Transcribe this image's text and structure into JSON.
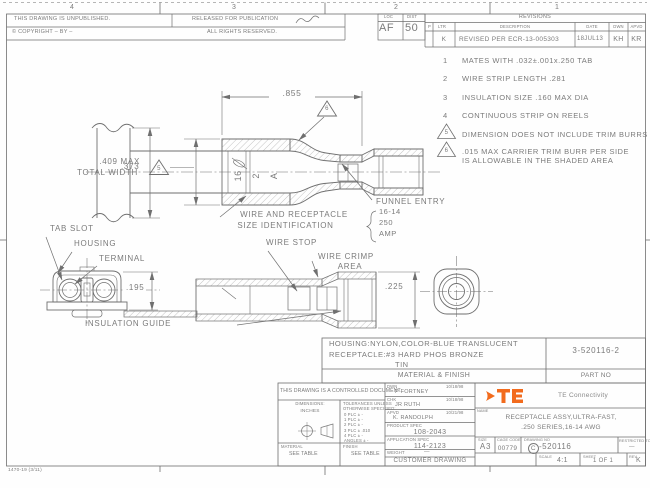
{
  "zones": {
    "z4": "4",
    "z3": "3",
    "z2": "2",
    "z1": "1"
  },
  "header": {
    "unpublished": "THIS DRAWING IS UNPUBLISHED.",
    "released": "RELEASED FOR PUBLICATION",
    "copyright": "© COPYRIGHT –  BY –",
    "rights": "ALL RIGHTS RESERVED.",
    "loc_label": "LOC",
    "loc_value": "AF",
    "dist_label": "DIST",
    "dist_value": "50"
  },
  "revisions": {
    "title": "REVISIONS",
    "col_p": "P",
    "col_ltr": "LTR",
    "col_desc": "DESCRIPTION",
    "col_date": "DATE",
    "col_dwn": "DWN",
    "col_apvd": "APVD",
    "row_ltr": "K",
    "row_desc": "REVISED PER ECR-13-005303",
    "row_date": "18JUL13",
    "row_dwn": "KH",
    "row_apvd": "KR"
  },
  "notes": {
    "n1_num": "1",
    "n1": "MATES WITH .032±.001x.250 TAB",
    "n2_num": "2",
    "n2": "WIRE STRIP LENGTH .281",
    "n3_num": "3",
    "n3": "INSULATION SIZE .160 MAX DIA",
    "n4_num": "4",
    "n4": "CONTINUOUS STRIP ON REELS",
    "n5_num": "5",
    "n5": "DIMENSION DOES NOT INCLUDE TRIM BURRS",
    "n6_num": "6",
    "n6a": ".015 MAX CARRIER TRIM BURR PER SIDE",
    "n6b": "IS ALLOWABLE IN THE SHADED AREA"
  },
  "views": {
    "dim_855": ".855",
    "dim_409_l1": ".409 MAX",
    "dim_409_l2": "TOTAL WIDTH",
    "dim_373": ".373",
    "flag_5": "5",
    "flag_6": "6",
    "funnel_entry": "FUNNEL ENTRY",
    "size_id_l1": "WIRE AND RECEPTACLE",
    "size_id_l2": "SIZE IDENTIFICATION",
    "size_v1": "16-14",
    "size_v2": "250",
    "size_v3": "AMP",
    "stamp_1": "16",
    "stamp_2": "2",
    "stamp_3": "A",
    "tab_slot": "TAB SLOT",
    "housing": "HOUSING",
    "terminal": "TERMINAL",
    "dim_195": ".195",
    "wire_stop": "WIRE STOP",
    "wire_crimp_l1": "WIRE CRIMP",
    "wire_crimp_l2": "AREA",
    "dim_225": ".225",
    "insulation_guide": "INSULATION GUIDE"
  },
  "material": {
    "line1": "HOUSING:NYLON,COLOR-BLUE TRANSLUCENT",
    "line2": "RECEPTACLE:#3 HARD PHOS BRONZE",
    "line3": "TIN",
    "header": "MATERIAL & FINISH",
    "part_no": "3-520116-2",
    "part_no_label": "PART NO"
  },
  "title": {
    "controlled": "THIS DRAWING IS A CONTROLLED DOCUMENT.",
    "dimensions_label": "DIMENSIONS:",
    "units": "INCHES",
    "tol_l1": "TOLERANCES UNLESS",
    "tol_l2": "OTHERWISE SPECIFIED:",
    "tol_r0": "0 PLC   ± -",
    "tol_r1": "1 PLC   ± -",
    "tol_r2": "2 PLC   ± -",
    "tol_r3": "3 PLC   ± .010",
    "tol_r4": "4 PLC   ± -",
    "tol_r5": "ANGLES  ± -",
    "material_label": "MATERIAL",
    "material_value": "SEE TABLE",
    "finish_label": "FINISH",
    "finish_value": "SEE TABLE",
    "dwn_label": "DWN",
    "dwn_name": "P FORTNEY",
    "dwn_date": "10/18/98",
    "chk_label": "CHK",
    "chk_name": "JR RUTH",
    "chk_date": "10/18/98",
    "apvd_label": "APVD",
    "apvd_name": "K. RANDOLPH",
    "apvd_date": "10/21/98",
    "product_spec_label": "PRODUCT SPEC",
    "product_spec": "108-2043",
    "app_spec_label": "APPLICATION SPEC",
    "app_spec": "114-2123",
    "weight_label": "WEIGHT",
    "weight_value": "—",
    "customer_drawing": "CUSTOMER DRAWING",
    "logo_text": "TE",
    "company": "TE Connectivity",
    "name_label": "NAME",
    "name_l1": "RECEPTACLE ASSY,ULTRA-FAST,",
    "name_l2": ".250 SERIES,16-14 AWG",
    "size_label": "SIZE",
    "size_value": "A3",
    "cage_label": "CAGE CODE",
    "cage_value": "00779",
    "dwg_label": "DRAWING NO",
    "dwg_prefix": "C",
    "dwg_suffix": "-520116",
    "restricted_label": "RESTRICTED TO",
    "restricted_value": "—",
    "scale_label": "SCALE",
    "scale_value": "4:1",
    "sheet_label": "SHEET",
    "sheet_value": "1 OF 1",
    "rev_label": "REV",
    "rev_value": "K"
  },
  "footer": {
    "form_no": "1470-19  (3/11)"
  },
  "colors": {
    "line": "#6f6f6f",
    "text": "#7b7b7b",
    "te_orange": "#f26b1d"
  }
}
